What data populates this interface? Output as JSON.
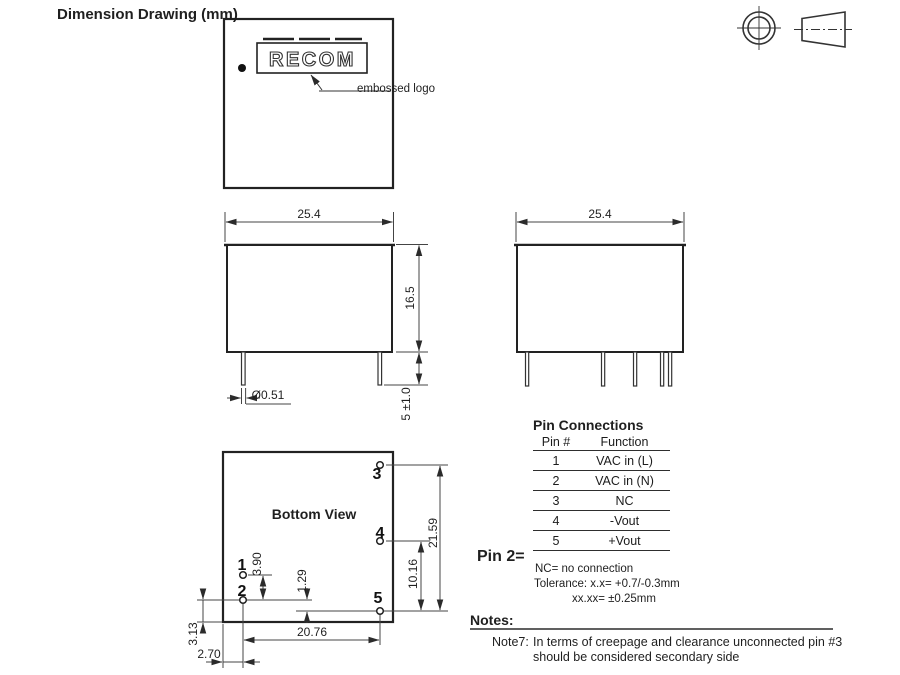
{
  "page": {
    "title": "Dimension Drawing (mm)"
  },
  "top_view": {
    "logo_text": "RECOM",
    "embossed_label": "embossed logo"
  },
  "front_view": {
    "width": "25.4",
    "height": "16.5",
    "pin_diameter": "Ø0.51",
    "pin_length": "5 ±1.0"
  },
  "side_view": {
    "width": "25.4"
  },
  "bottom_view": {
    "title": "Bottom View",
    "pin_labels": [
      "1",
      "2",
      "3",
      "4",
      "5"
    ],
    "dims": {
      "pin1_pin2": "3.90",
      "pin2_pin5": "1.29",
      "pin4_pin5": "10.16",
      "pin3_pin5": "21.59",
      "pin_row_span": "20.76",
      "edge_offset_y": "3.13",
      "edge_offset_x": "2.70"
    }
  },
  "pin_table": {
    "title": "Pin Connections",
    "headers": [
      "Pin #",
      "Function"
    ],
    "rows": [
      [
        "1",
        "VAC in (L)"
      ],
      [
        "2",
        "VAC in (N)"
      ],
      [
        "3",
        "NC"
      ],
      [
        "4",
        "-Vout"
      ],
      [
        "5",
        "+Vout"
      ]
    ]
  },
  "pin2_label": "Pin 2=",
  "tolerances": {
    "nc_note": "NC= no connection",
    "line1": "Tolerance:  x.x=  +0.7/-0.3mm",
    "line2": "xx.xx=    ±0.25mm"
  },
  "notes": {
    "title": "Notes:",
    "note_id": "Note7:",
    "line1": "In terms of creepage and clearance unconnected pin #3",
    "line2": "should be considered secondary side"
  },
  "colors": {
    "line": "#2b2b2b",
    "thin_line": "#444444",
    "text": "#1a1a1a"
  }
}
